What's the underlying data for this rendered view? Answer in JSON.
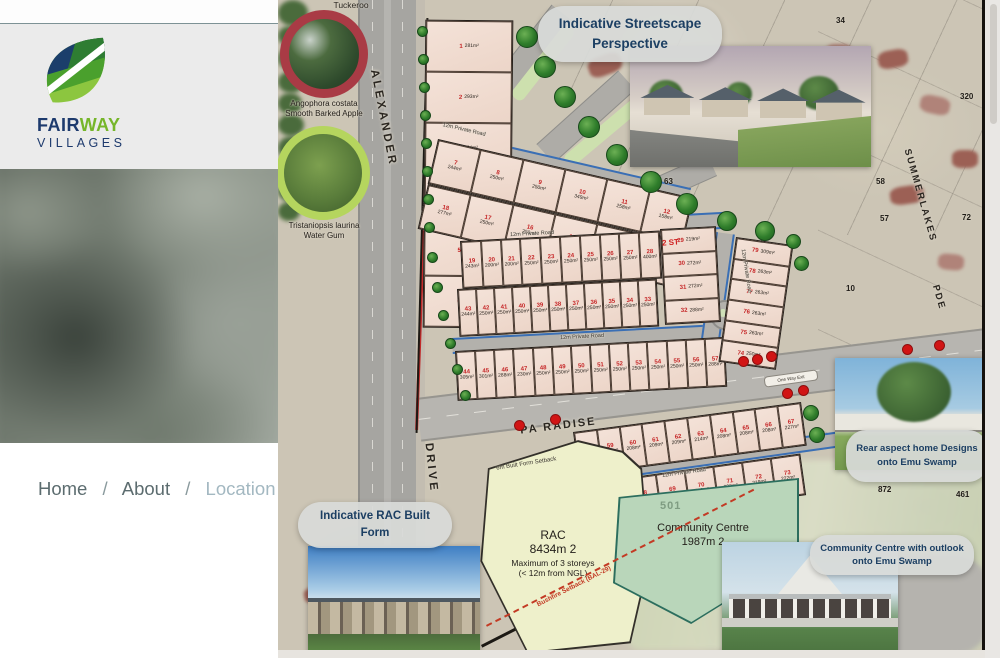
{
  "sidebar": {
    "logo": {
      "fair": "FAIR",
      "way": "WAY",
      "villages": "VILLAGES"
    },
    "nav": {
      "separator": "/",
      "items": [
        {
          "label": "Home"
        },
        {
          "label": "About"
        },
        {
          "label": "Location"
        }
      ]
    }
  },
  "map": {
    "tree_legend": {
      "title": "Tuckeroo",
      "items": [
        {
          "name_latin": "Angophora costata",
          "name_common": "Smooth Barked Apple",
          "ring_color": "#a93b45"
        },
        {
          "name_latin": "Tristaniopsis laurina",
          "name_common": "Water Gum",
          "ring_color": "#b5d55e"
        }
      ]
    },
    "streets": {
      "alexander": "ALEXANDER",
      "drive": "DRIVE",
      "paradise": "PA RADISE",
      "summerlakes": "SUMMERLAKES",
      "pde": "PDE"
    },
    "road_label": "12m Private Road",
    "callouts": {
      "streetscape": "Indicative Streetscape Perspective",
      "rac": "Indicative RAC Built Form",
      "rear_aspect": "Rear aspect home Designs onto Emu Swamp",
      "community_centre": "Community Centre with outlook onto Emu Swamp"
    },
    "zones": {
      "rac": {
        "name": "RAC",
        "area": "8434m 2",
        "line3": "Maximum of 3 storeys",
        "line4": "(< 12m from NGL)"
      },
      "community_centre": {
        "name": "Community Centre",
        "area": "1987m 2",
        "parcel": "501"
      }
    },
    "annotations": {
      "setback_top": "6m Built Form Setback",
      "bushfire": "Bushfire Setback (BAL-29)",
      "two_storey": "2 ST",
      "exit": "One Way Exit"
    },
    "parcel_numbers": [
      "34",
      "320",
      "72",
      "63",
      "58",
      "57",
      "10",
      "872",
      "461"
    ],
    "marker_color": "#d11414",
    "tree_marker_color": "#2f7d2b",
    "lot_blocks": {
      "block_1_6": {
        "lots": [
          {
            "n": 1,
            "a": "281m²"
          },
          {
            "n": 2,
            "a": "293m²"
          },
          {
            "n": 3,
            "a": "284m²"
          },
          {
            "n": 4,
            "a": "286m²"
          },
          {
            "n": 5,
            "a": "287m²"
          },
          {
            "n": 6,
            "a": "220m²"
          }
        ]
      },
      "block_7_12": {
        "lots": [
          {
            "n": 7,
            "a": "244m²"
          },
          {
            "n": 8,
            "a": "250m²"
          },
          {
            "n": 9,
            "a": "250m²"
          },
          {
            "n": 10,
            "a": "349m²"
          },
          {
            "n": 11,
            "a": "258m²"
          },
          {
            "n": 12,
            "a": "158m²"
          }
        ]
      },
      "block_13_18": {
        "lots": [
          {
            "n": 18,
            "a": "277m²"
          },
          {
            "n": 17,
            "a": "250m²"
          },
          {
            "n": 16,
            "a": "250m²"
          },
          {
            "n": 15,
            "a": "185m²"
          },
          {
            "n": 14,
            "a": "165m²"
          },
          {
            "n": 13,
            "a": "211m²"
          }
        ]
      },
      "block_19_28": {
        "lots": [
          {
            "n": 19,
            "a": "243m²"
          },
          {
            "n": 20,
            "a": "200m²"
          },
          {
            "n": 21,
            "a": "200m²"
          },
          {
            "n": 22,
            "a": "250m²"
          },
          {
            "n": 23,
            "a": "250m²"
          },
          {
            "n": 24,
            "a": "250m²"
          },
          {
            "n": 25,
            "a": "250m²"
          },
          {
            "n": 26,
            "a": "250m²"
          },
          {
            "n": 27,
            "a": "250m²"
          },
          {
            "n": 28,
            "a": "400m²"
          }
        ]
      },
      "block_29_32": {
        "lots": [
          {
            "n": 29,
            "a": "219m²"
          },
          {
            "n": 30,
            "a": "272m²"
          },
          {
            "n": 31,
            "a": "272m²"
          },
          {
            "n": 32,
            "a": "288m²"
          }
        ]
      },
      "block_33_43": {
        "lots": [
          {
            "n": 43,
            "a": "244m²"
          },
          {
            "n": 42,
            "a": "250m²"
          },
          {
            "n": 41,
            "a": "250m²"
          },
          {
            "n": 40,
            "a": "250m²"
          },
          {
            "n": 39,
            "a": "250m²"
          },
          {
            "n": 38,
            "a": "250m²"
          },
          {
            "n": 37,
            "a": "250m²"
          },
          {
            "n": 36,
            "a": "250m²"
          },
          {
            "n": 35,
            "a": "250m²"
          },
          {
            "n": 34,
            "a": "250m²"
          },
          {
            "n": 33,
            "a": "250m²"
          }
        ]
      },
      "block_44_57": {
        "lots": [
          {
            "n": 44,
            "a": "305m²"
          },
          {
            "n": 45,
            "a": "301m²"
          },
          {
            "n": 46,
            "a": "288m²"
          },
          {
            "n": 47,
            "a": "230m²"
          },
          {
            "n": 48,
            "a": "250m²"
          },
          {
            "n": 49,
            "a": "250m²"
          },
          {
            "n": 50,
            "a": "250m²"
          },
          {
            "n": 51,
            "a": "250m²"
          },
          {
            "n": 52,
            "a": "250m²"
          },
          {
            "n": 53,
            "a": "250m²"
          },
          {
            "n": 54,
            "a": "250m²"
          },
          {
            "n": 55,
            "a": "250m²"
          },
          {
            "n": 56,
            "a": "250m²"
          },
          {
            "n": 57,
            "a": "288m²"
          }
        ]
      },
      "block_58_67": {
        "lots": [
          {
            "n": 58,
            "a": "211m²"
          },
          {
            "n": 59,
            "a": "208m²"
          },
          {
            "n": 60,
            "a": "208m²"
          },
          {
            "n": 61,
            "a": "209m²"
          },
          {
            "n": 62,
            "a": "209m²"
          },
          {
            "n": 63,
            "a": "214m²"
          },
          {
            "n": 64,
            "a": "208m²"
          },
          {
            "n": 65,
            "a": "208m²"
          },
          {
            "n": 66,
            "a": "208m²"
          },
          {
            "n": 67,
            "a": "227m²"
          }
        ]
      },
      "block_68_73": {
        "lots": [
          {
            "n": 68,
            "a": "238m²"
          },
          {
            "n": 69,
            "a": "174m²"
          },
          {
            "n": 70,
            "a": "210m²"
          },
          {
            "n": 71,
            "a": "232m²"
          },
          {
            "n": 72,
            "a": "219m²"
          },
          {
            "n": 73,
            "a": "222m²"
          }
        ]
      },
      "block_74_79": {
        "lots": [
          {
            "n": 79,
            "a": "309m²"
          },
          {
            "n": 78,
            "a": "263m²"
          },
          {
            "n": 77,
            "a": "263m²"
          },
          {
            "n": 76,
            "a": "263m²"
          },
          {
            "n": 75,
            "a": "263m²"
          },
          {
            "n": 74,
            "a": "250m²"
          }
        ]
      }
    }
  }
}
